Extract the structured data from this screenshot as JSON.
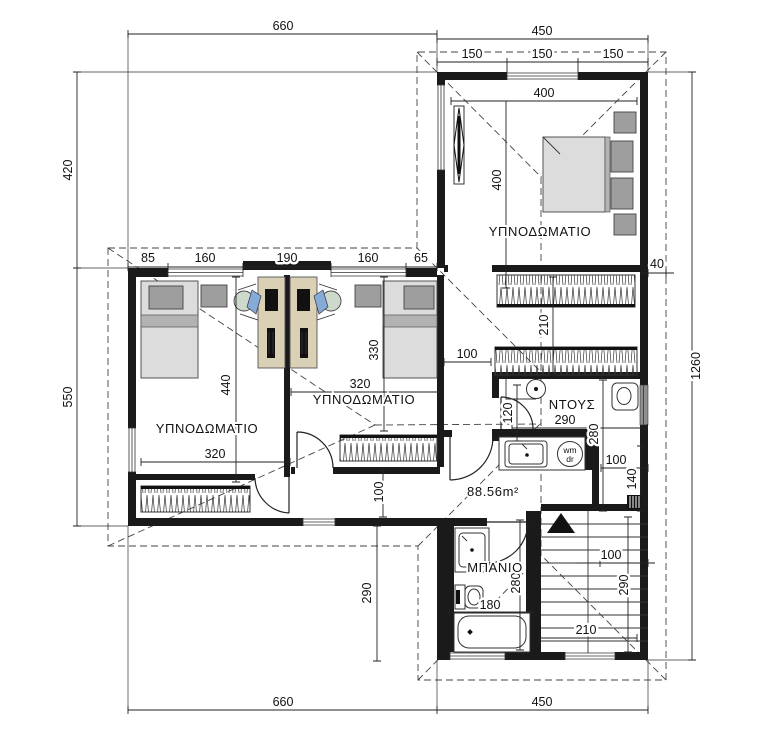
{
  "labels": {
    "bedroom": "ΥΠΝΟΔΩΜΑΤΙΟ",
    "shower": "ΝΤΟΥΣ",
    "bath": "ΜΠΑΝΙΟ",
    "area": "88.56m²",
    "washer_top": "wm",
    "washer_bottom": "dr"
  },
  "dims": {
    "top660": "660",
    "top450": "450",
    "t150a": "150",
    "t150b": "150",
    "t150c": "150",
    "left420": "420",
    "left550": "550",
    "right1260": "1260",
    "over40": "40",
    "bot660": "660",
    "bot450": "450",
    "w85": "85",
    "w160a": "160",
    "w190": "190",
    "w160b": "160",
    "w65": "65",
    "br400h": "400",
    "br400v": "400",
    "dress210": "210",
    "hall100": "100",
    "shower120": "120",
    "shower290": "290",
    "wc280": "280",
    "wc100": "100",
    "wc140": "140",
    "brB330": "330",
    "brB320": "320",
    "brA440": "440",
    "brA320": "320",
    "corr100": "100",
    "left290": "290",
    "bath280": "280",
    "bath180": "180",
    "st100": "100",
    "st290": "290",
    "st210": "210"
  },
  "colors": {
    "wall": "#1a1a1a",
    "dashed_roof": "#444444",
    "desk": "#d9d0b6",
    "chair_seat": "#85abd8",
    "chair_back": "#ccd9cb",
    "furniture_light": "#dcdcdc",
    "furniture_dark": "#9e9e9e"
  }
}
